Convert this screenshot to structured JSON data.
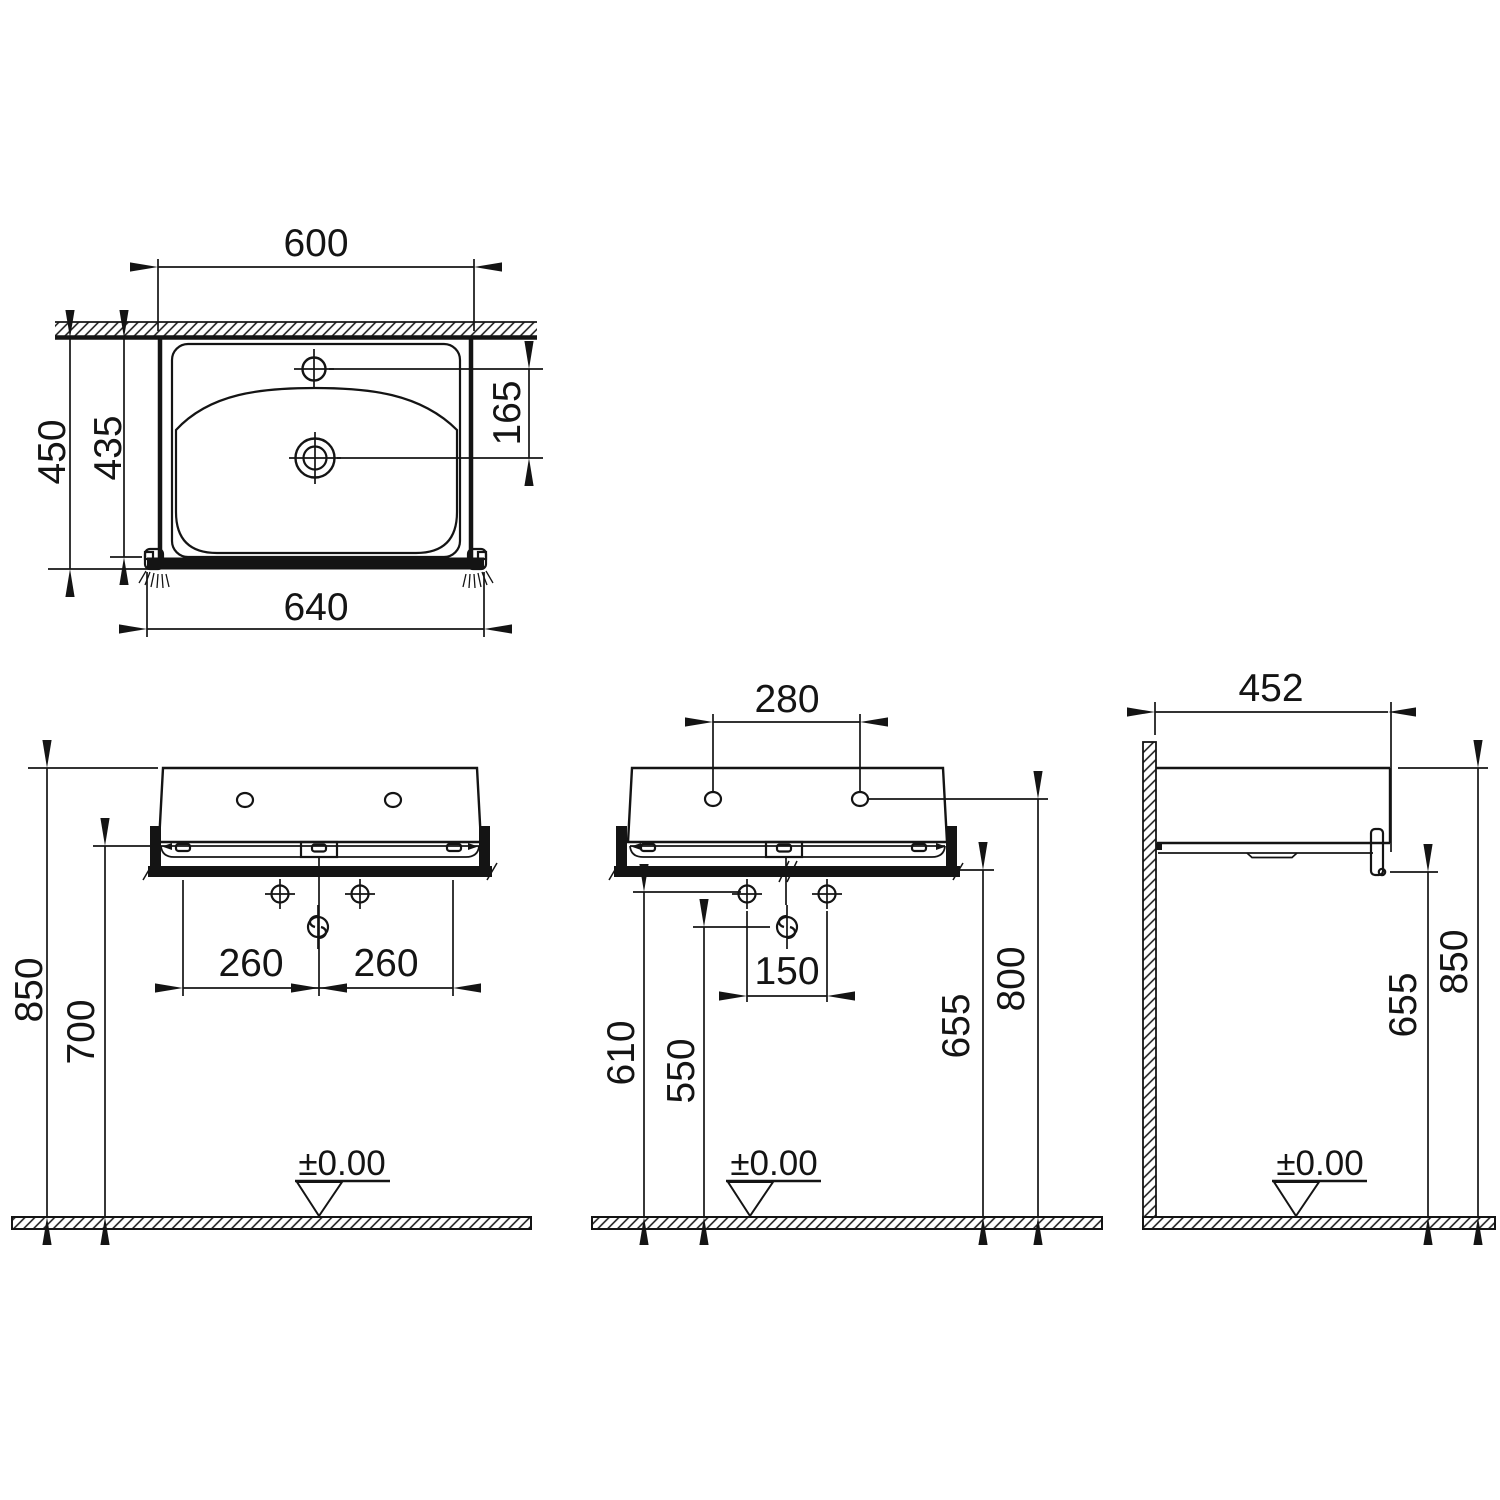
{
  "drawing": {
    "datum": "±0.00",
    "plan": {
      "width_top": "600",
      "width_total": "640",
      "depth_total": "450",
      "depth_inner": "435",
      "tap_to_drain": "165"
    },
    "front": {
      "height_overall": "850",
      "height_underside": "700",
      "fixing_left": "260",
      "fixing_right": "260"
    },
    "front2": {
      "tap_spacing": "280",
      "fixing_spacing": "150",
      "height_fixing": "610",
      "height_drain": "550",
      "height_underside": "655",
      "height_taphole": "800"
    },
    "side": {
      "depth": "452",
      "height_underside": "655",
      "height_overall": "850"
    }
  }
}
